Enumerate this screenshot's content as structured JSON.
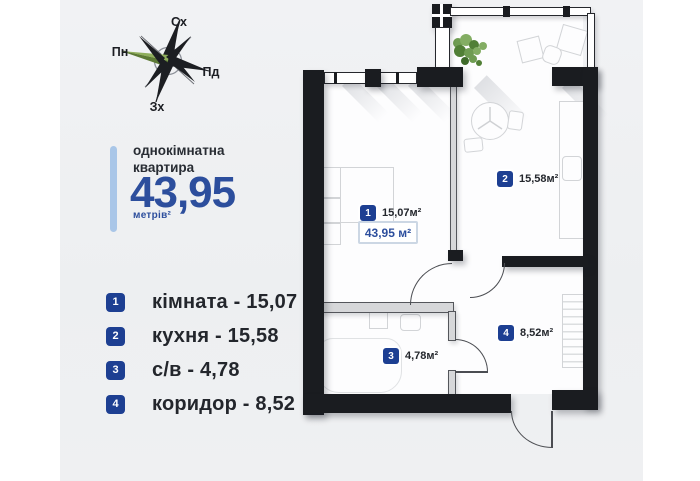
{
  "compass": {
    "top": "Сх",
    "left": "Пн",
    "right": "Пд",
    "bottom": "Зх"
  },
  "summary": {
    "title": "однокімнатна\nквартира",
    "area": "43,95",
    "unit": "метрів²"
  },
  "legend": [
    {
      "num": "1",
      "label": "кімната - 15,07"
    },
    {
      "num": "2",
      "label": "кухня - 15,58"
    },
    {
      "num": "3",
      "label": "с/в - 4,78"
    },
    {
      "num": "4",
      "label": "коридор - 8,52"
    }
  ],
  "plan": {
    "total": "43,95 м²",
    "rooms": [
      {
        "num": "1",
        "area": "15,07м²"
      },
      {
        "num": "2",
        "area": "15,58м²"
      },
      {
        "num": "3",
        "area": "4,78м²"
      },
      {
        "num": "4",
        "area": "8,52м²"
      }
    ]
  },
  "colors": {
    "accent_blue": "#2c4e9d",
    "badge_navy": "#1d3f92",
    "accent_bar": "#a9c6e8",
    "wall": "#1a1c20"
  }
}
